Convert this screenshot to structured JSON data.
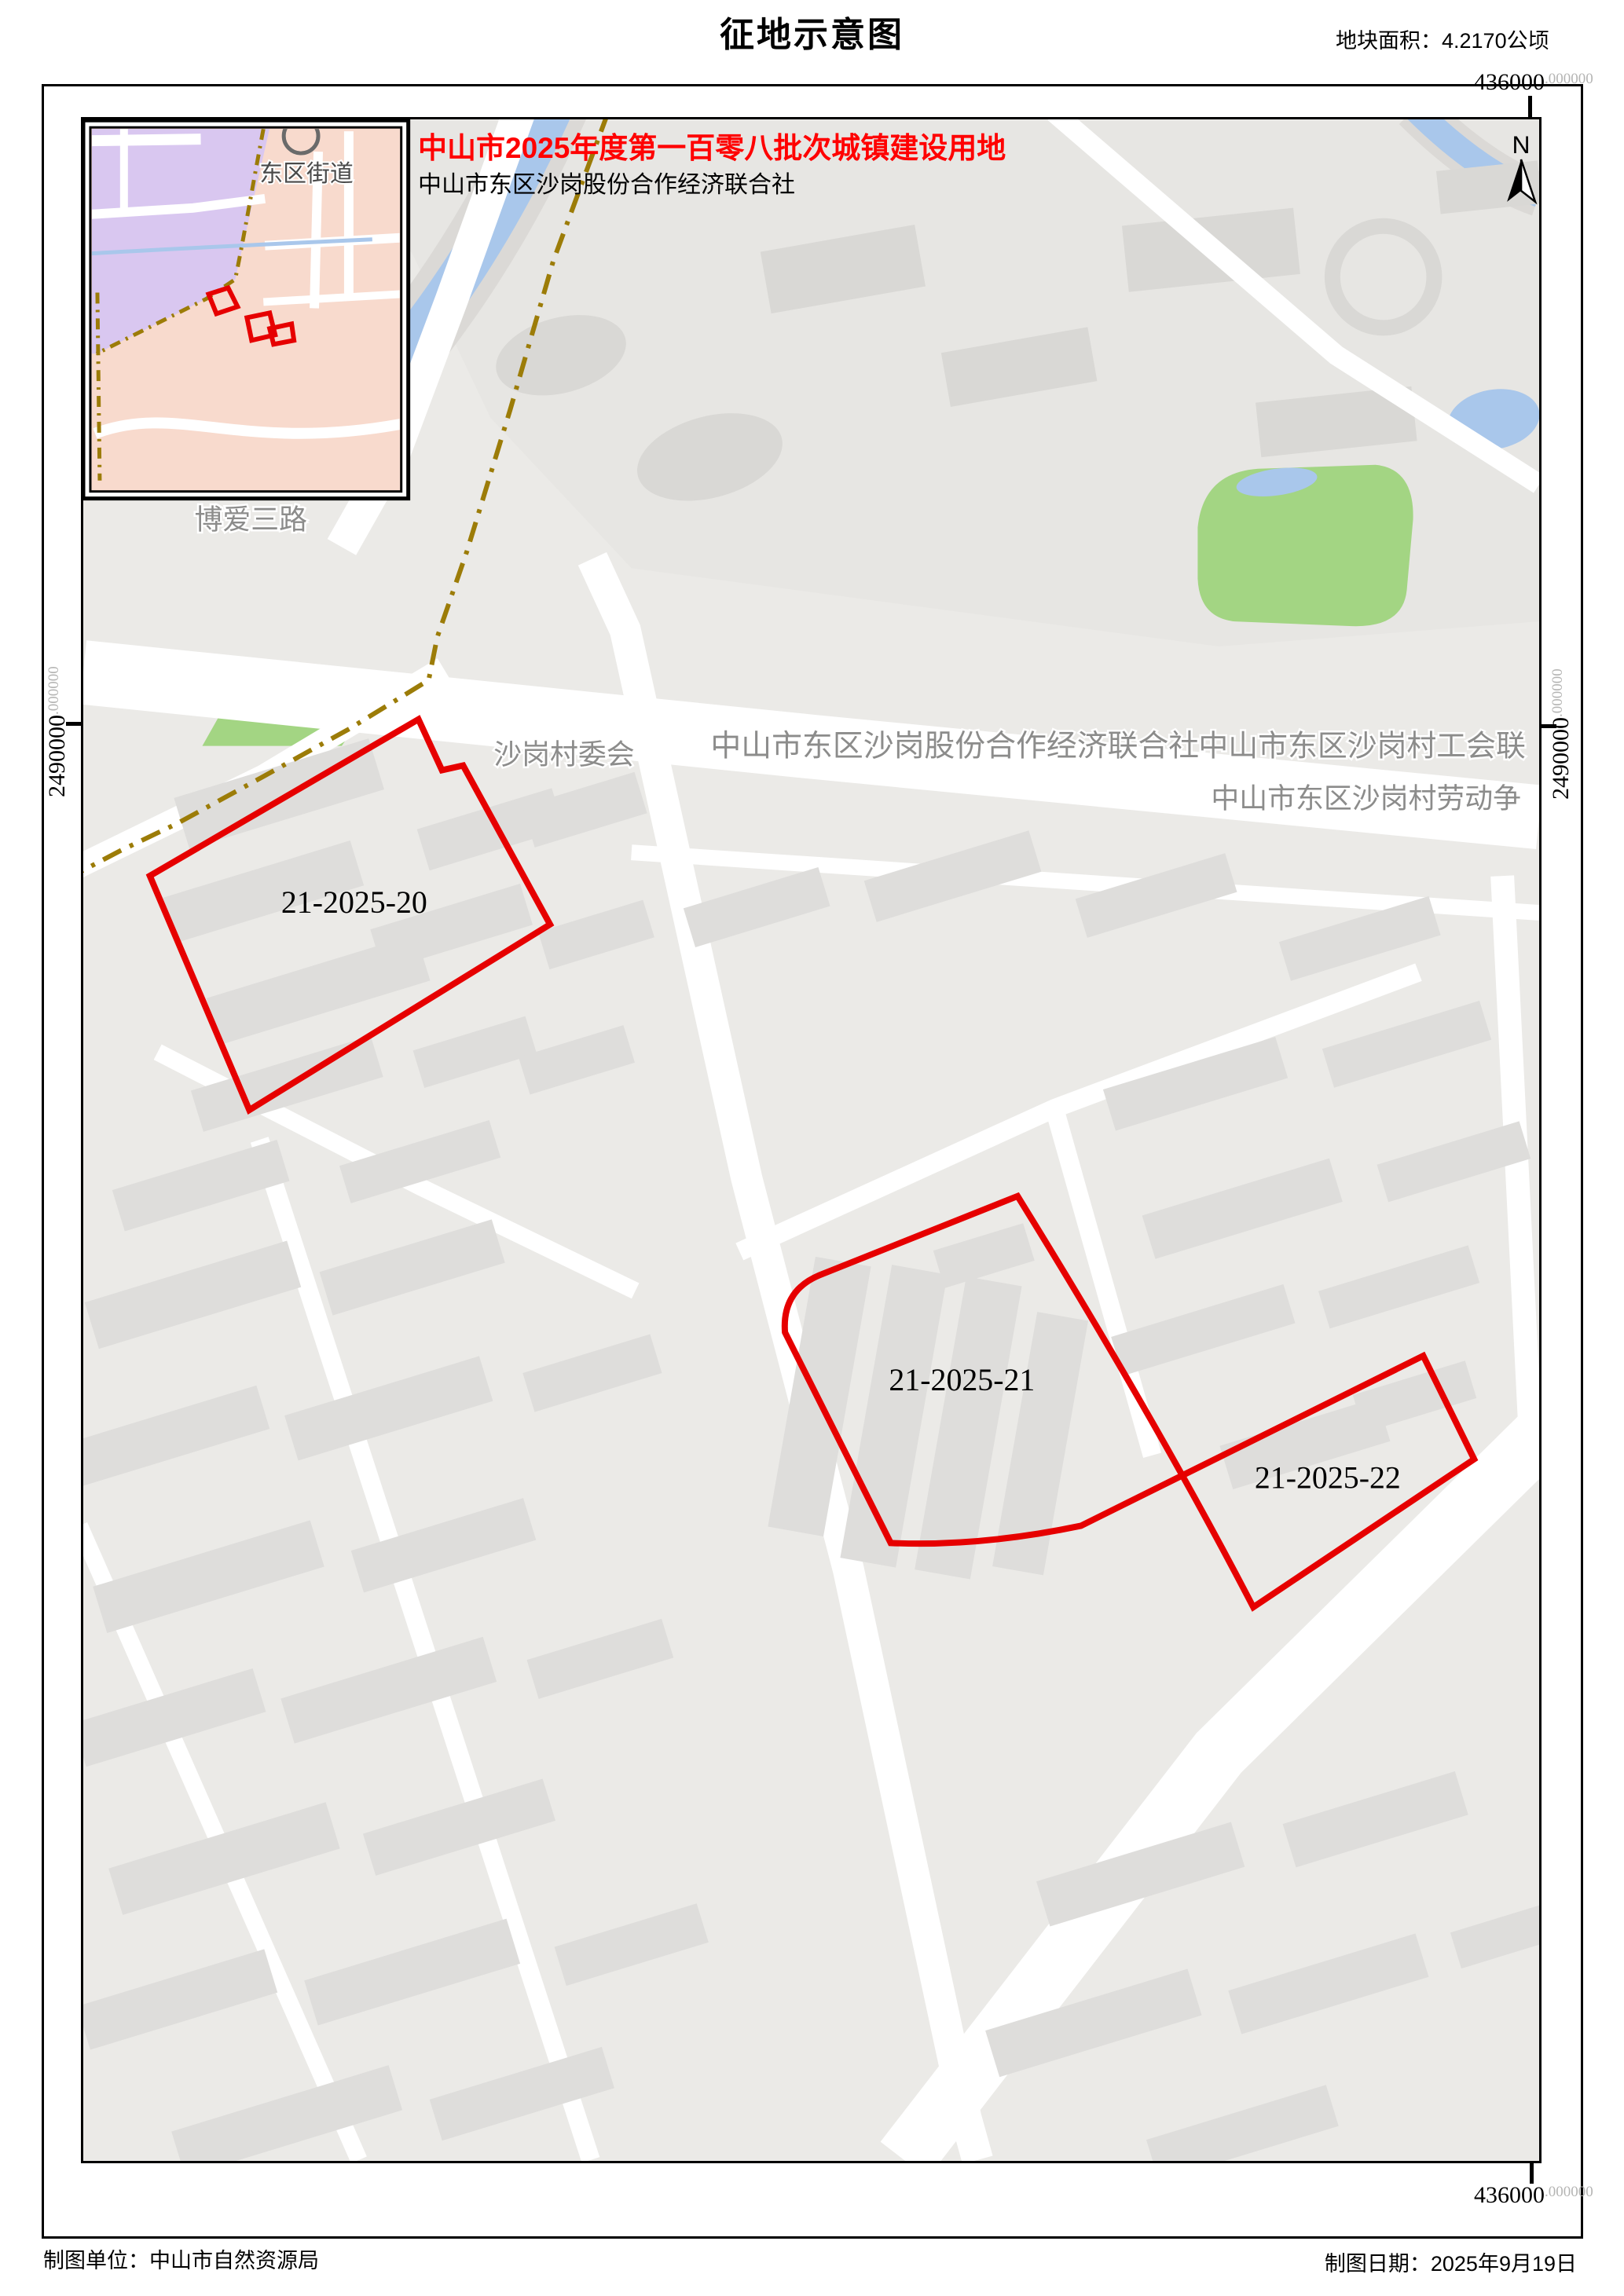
{
  "page": {
    "title": "征地示意图",
    "area_label": "地块面积：4.2170公顷",
    "footer_left": "制图单位：中山市自然资源局",
    "footer_right": "制图日期：2025年9月19日"
  },
  "header": {
    "batch_title": "中山市2025年度第一百零八批次城镇建设用地",
    "applicant": "中山市东区沙岗股份合作经济联合社"
  },
  "north": {
    "label": "N"
  },
  "coords": {
    "top": {
      "main": "436000",
      "suffix": ".000000"
    },
    "bottom": {
      "main": "436000",
      "suffix": ".000000"
    },
    "left": {
      "main": "2490000",
      "suffix": ".000000"
    },
    "right": {
      "main": "2490000",
      "suffix": ".000000"
    }
  },
  "parcels": [
    {
      "id": "21-2025-20"
    },
    {
      "id": "21-2025-21"
    },
    {
      "id": "21-2025-22"
    }
  ],
  "map_labels": {
    "village_committee": "沙岗村委会",
    "economic_coop": "中山市东区沙岗股份合作经济联合社",
    "workers_union": "中山市东区沙岗村工会联",
    "labor_dispute": "中山市东区沙岗村劳动争",
    "road_boai": "博爱三路",
    "inset_subdistrict": "东区街道"
  },
  "colors": {
    "parcel_outline": "#e60000",
    "header_red": "#ff0000",
    "boundary_line": "#9c7c08",
    "water": "#a9c7eb",
    "park": "#a3d583",
    "inset_purple": "#d9c7f0",
    "inset_pink": "#f8dacd"
  }
}
